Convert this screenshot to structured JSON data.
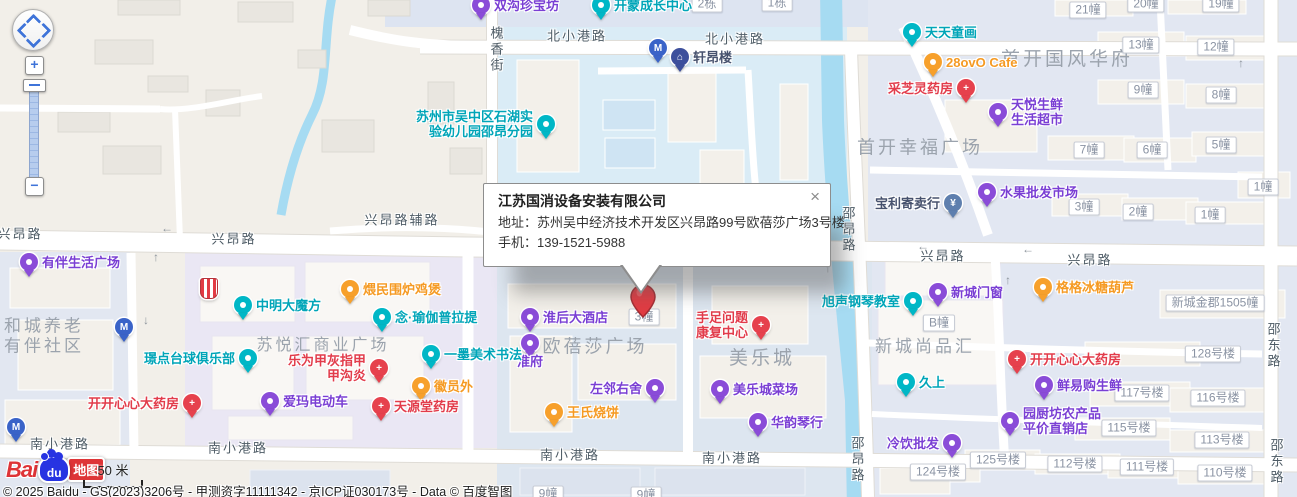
{
  "popup": {
    "title": "江苏国消设备安装有限公司",
    "address_label": "地址：",
    "address_value": "苏州吴中经济技术开发区兴昂路99号欧蓓莎广场3号楼",
    "phone_label": "手机：",
    "phone_value": "139-1521-5988",
    "close": "×"
  },
  "controls": {
    "zoom_in": "+",
    "zoom_out": "−"
  },
  "logo": {
    "bai": "Bai",
    "du": "du",
    "ditu": "地图"
  },
  "scale": {
    "label": "50 米"
  },
  "copyright": "© 2025 Baidu - GS(2023)3206号 - 甲测资字11111342 - 京ICP证030173号 - Data © 百度智图",
  "colors": {
    "teal": "#00b7c6",
    "purple": "#8a4cd8",
    "orange": "#f7a02b",
    "red": "#e6414d",
    "navy": "#3d4f9c",
    "blue": "#3a63c8",
    "steel": "#5e7fae",
    "label_teal": "#00a5b8",
    "label_purple": "#7a3fd4",
    "label_orange": "#f59a23",
    "label_red": "#e23c4b",
    "label_navy": "#47526e",
    "label_steel": "#47526e"
  },
  "map": {
    "road_labels": [
      {
        "x": 577,
        "y": 35,
        "text": "北小港路"
      },
      {
        "x": 735,
        "y": 38,
        "text": "北小港路"
      },
      {
        "x": 496,
        "y": 50,
        "text": "槐香街",
        "vertical": true
      },
      {
        "x": 402,
        "y": 219,
        "text": "兴昂路辅路"
      },
      {
        "x": 20,
        "y": 233,
        "text": "兴昂路"
      },
      {
        "x": 234,
        "y": 238,
        "text": "兴昂路"
      },
      {
        "x": 943,
        "y": 255,
        "text": "兴昂路"
      },
      {
        "x": 1090,
        "y": 259,
        "text": "兴昂路"
      },
      {
        "x": 60,
        "y": 443,
        "text": "南小港路"
      },
      {
        "x": 238,
        "y": 447,
        "text": "南小港路"
      },
      {
        "x": 570,
        "y": 454,
        "text": "南小港路"
      },
      {
        "x": 732,
        "y": 457,
        "text": "南小港路"
      },
      {
        "x": 848,
        "y": 230,
        "text": "邵昂路",
        "vertical": true
      },
      {
        "x": 857,
        "y": 460,
        "text": "邵昂路",
        "vertical": true
      },
      {
        "x": 1273,
        "y": 346,
        "text": "邵东路",
        "vertical": true
      },
      {
        "x": 1276,
        "y": 462,
        "text": "邵东路",
        "vertical": true
      }
    ],
    "area_labels": [
      {
        "x": 1067,
        "y": 60,
        "size": 19,
        "lines": [
          "首开国风华府"
        ]
      },
      {
        "x": 920,
        "y": 148,
        "size": 18,
        "lines": [
          "首开幸福广场"
        ]
      },
      {
        "x": 925,
        "y": 347,
        "size": 17,
        "lines": [
          "新城尚品汇"
        ]
      },
      {
        "x": 762,
        "y": 359,
        "size": 19,
        "lines": [
          "美乐城"
        ]
      },
      {
        "x": 595,
        "y": 347,
        "size": 18,
        "lines": [
          "欧蓓莎广场"
        ]
      },
      {
        "x": 323,
        "y": 346,
        "size": 16,
        "lines": [
          "苏悦汇商业广场"
        ]
      },
      {
        "x": 44,
        "y": 336,
        "size": 17,
        "lines": [
          "和城养老",
          "有伴社区"
        ]
      }
    ],
    "building_labels": [
      {
        "x": 707,
        "y": 4,
        "text": "2栋"
      },
      {
        "x": 777,
        "y": 3,
        "text": "1栋"
      },
      {
        "x": 1088,
        "y": 10,
        "text": "21幢"
      },
      {
        "x": 1146,
        "y": 4,
        "text": "20幢"
      },
      {
        "x": 1221,
        "y": 4,
        "text": "19幢"
      },
      {
        "x": 1141,
        "y": 45,
        "text": "13幢"
      },
      {
        "x": 1216,
        "y": 47,
        "text": "12幢"
      },
      {
        "x": 1143,
        "y": 90,
        "text": "9幢"
      },
      {
        "x": 1221,
        "y": 95,
        "text": "8幢"
      },
      {
        "x": 1089,
        "y": 150,
        "text": "7幢"
      },
      {
        "x": 1152,
        "y": 150,
        "text": "6幢"
      },
      {
        "x": 1221,
        "y": 145,
        "text": "5幢"
      },
      {
        "x": 1263,
        "y": 187,
        "text": "1幢"
      },
      {
        "x": 1084,
        "y": 207,
        "text": "3幢"
      },
      {
        "x": 1138,
        "y": 212,
        "text": "2幢"
      },
      {
        "x": 1210,
        "y": 215,
        "text": "1幢"
      },
      {
        "x": 939,
        "y": 323,
        "text": "B幢"
      },
      {
        "x": 1215,
        "y": 303,
        "text": "新城金郡1505幢"
      },
      {
        "x": 644,
        "y": 317,
        "text": "3幢"
      },
      {
        "x": 1213,
        "y": 354,
        "text": "128号楼"
      },
      {
        "x": 1142,
        "y": 393,
        "text": "117号楼"
      },
      {
        "x": 1218,
        "y": 398,
        "text": "116号楼"
      },
      {
        "x": 1129,
        "y": 428,
        "text": "115号楼"
      },
      {
        "x": 1222,
        "y": 440,
        "text": "113号楼"
      },
      {
        "x": 998,
        "y": 460,
        "text": "125号楼"
      },
      {
        "x": 938,
        "y": 472,
        "text": "124号楼"
      },
      {
        "x": 1075,
        "y": 464,
        "text": "112号楼"
      },
      {
        "x": 1147,
        "y": 467,
        "text": "111号楼"
      },
      {
        "x": 1225,
        "y": 473,
        "text": "110号楼"
      },
      {
        "x": 548,
        "y": 494,
        "text": "9幢"
      },
      {
        "x": 646,
        "y": 495,
        "text": "9幢"
      }
    ],
    "arrows": [
      {
        "x": 167,
        "y": 228,
        "ch": "←"
      },
      {
        "x": 923,
        "y": 246,
        "ch": "←"
      },
      {
        "x": 1028,
        "y": 249,
        "ch": "←"
      },
      {
        "x": 156,
        "y": 257,
        "ch": "↑"
      },
      {
        "x": 146,
        "y": 320,
        "ch": "↓"
      },
      {
        "x": 828,
        "y": 268,
        "ch": "↑"
      },
      {
        "x": 1241,
        "y": 63,
        "ch": "↑"
      },
      {
        "x": 1008,
        "y": 280,
        "ch": "↑"
      }
    ],
    "pois": [
      {
        "x": 481,
        "y": 5,
        "color": "purple",
        "glyph": "",
        "lines": [
          "双沟珍宝坊"
        ],
        "side": "right",
        "label_color": "label_purple"
      },
      {
        "x": 601,
        "y": 5,
        "color": "teal",
        "glyph": "",
        "lines": [
          "开蒙成长中心"
        ],
        "side": "right",
        "label_color": "label_teal"
      },
      {
        "x": 912,
        "y": 32,
        "color": "teal",
        "glyph": "",
        "lines": [
          "天天童画"
        ],
        "side": "right",
        "label_color": "label_teal"
      },
      {
        "x": 933,
        "y": 62,
        "color": "orange",
        "glyph": "",
        "lines": [
          "28ovO Cafe"
        ],
        "side": "right",
        "label_color": "label_orange"
      },
      {
        "x": 966,
        "y": 88,
        "color": "red",
        "glyph": "+",
        "lines": [
          "采芝灵药房"
        ],
        "side": "left",
        "label_color": "label_red"
      },
      {
        "x": 998,
        "y": 112,
        "color": "purple",
        "glyph": "",
        "lines": [
          "天悦生鲜",
          "生活超市"
        ],
        "side": "right",
        "label_color": "label_purple"
      },
      {
        "x": 546,
        "y": 124,
        "color": "teal",
        "glyph": "",
        "lines": [
          "苏州市吴中区石湖实",
          "验幼儿园邵昂分园"
        ],
        "side": "left",
        "label_color": "label_teal"
      },
      {
        "x": 680,
        "y": 57,
        "color": "navy",
        "glyph": "⌂",
        "lines": [
          "轩昂楼"
        ],
        "side": "right",
        "label_color": "label_navy"
      },
      {
        "x": 658,
        "y": 48,
        "color": "blue",
        "glyph": "M",
        "lines": [],
        "side": "right",
        "label_color": "label_navy"
      },
      {
        "x": 953,
        "y": 203,
        "color": "steel",
        "glyph": "¥",
        "lines": [
          "宝利寄卖行"
        ],
        "side": "left",
        "label_color": "label_steel"
      },
      {
        "x": 987,
        "y": 192,
        "color": "purple",
        "glyph": "",
        "lines": [
          "水果批发市场"
        ],
        "side": "right",
        "label_color": "label_purple"
      },
      {
        "x": 913,
        "y": 301,
        "color": "teal",
        "glyph": "",
        "lines": [
          "旭声钢琴教室"
        ],
        "side": "left",
        "label_color": "label_teal"
      },
      {
        "x": 938,
        "y": 292,
        "color": "purple",
        "glyph": "",
        "lines": [
          "新城门窗"
        ],
        "side": "right",
        "label_color": "label_purple"
      },
      {
        "x": 1043,
        "y": 287,
        "color": "orange",
        "glyph": "",
        "lines": [
          "格格冰糖葫芦"
        ],
        "side": "right",
        "label_color": "label_orange"
      },
      {
        "x": 906,
        "y": 382,
        "color": "teal",
        "glyph": "",
        "lines": [
          "久上"
        ],
        "side": "right",
        "label_color": "label_teal"
      },
      {
        "x": 1017,
        "y": 359,
        "color": "red",
        "glyph": "+",
        "lines": [
          "开开心心大药房"
        ],
        "side": "right",
        "label_color": "label_red"
      },
      {
        "x": 1044,
        "y": 385,
        "color": "purple",
        "glyph": "",
        "lines": [
          "鲜易购生鲜"
        ],
        "side": "right",
        "label_color": "label_purple"
      },
      {
        "x": 1010,
        "y": 421,
        "color": "purple",
        "glyph": "",
        "lines": [
          "园厨坊农产品",
          "平价直销店"
        ],
        "side": "right",
        "label_color": "label_purple"
      },
      {
        "x": 952,
        "y": 443,
        "color": "purple",
        "glyph": "",
        "lines": [
          "冷饮批发"
        ],
        "side": "left",
        "label_color": "label_purple"
      },
      {
        "x": 720,
        "y": 389,
        "color": "purple",
        "glyph": "",
        "lines": [
          "美乐城菜场"
        ],
        "side": "right",
        "label_color": "label_purple"
      },
      {
        "x": 758,
        "y": 422,
        "color": "purple",
        "glyph": "",
        "lines": [
          "华韵琴行"
        ],
        "side": "right",
        "label_color": "label_purple"
      },
      {
        "x": 761,
        "y": 325,
        "color": "red",
        "glyph": "+",
        "lines": [
          "手足问题",
          "康复中心"
        ],
        "side": "left",
        "label_color": "label_red"
      },
      {
        "x": 530,
        "y": 317,
        "color": "purple",
        "glyph": "",
        "lines": [
          "淮后大酒店"
        ],
        "side": "right",
        "label_color": "label_purple"
      },
      {
        "x": 530,
        "y": 343,
        "color": "purple",
        "glyph": "",
        "lines": [
          "淮府"
        ],
        "side": "below",
        "label_color": "label_purple"
      },
      {
        "x": 655,
        "y": 388,
        "color": "purple",
        "glyph": "",
        "lines": [
          "左邻右舍"
        ],
        "side": "left",
        "label_color": "label_purple"
      },
      {
        "x": 554,
        "y": 412,
        "color": "orange",
        "glyph": "",
        "lines": [
          "王氏烧饼"
        ],
        "side": "right",
        "label_color": "label_orange"
      },
      {
        "x": 431,
        "y": 354,
        "color": "teal",
        "glyph": "",
        "lines": [
          "一墨美术书法"
        ],
        "side": "right",
        "label_color": "label_teal"
      },
      {
        "x": 382,
        "y": 317,
        "color": "teal",
        "glyph": "",
        "lines": [
          "念·瑜伽普拉提"
        ],
        "side": "right",
        "label_color": "label_teal"
      },
      {
        "x": 350,
        "y": 289,
        "color": "orange",
        "glyph": "",
        "lines": [
          "煨民围炉鸡煲"
        ],
        "side": "right",
        "label_color": "label_orange"
      },
      {
        "x": 243,
        "y": 305,
        "color": "teal",
        "glyph": "",
        "lines": [
          "中明大魔方"
        ],
        "side": "right",
        "label_color": "label_teal"
      },
      {
        "x": 379,
        "y": 368,
        "color": "red",
        "glyph": "+",
        "lines": [
          "乐为甲灰指甲",
          "甲沟炎"
        ],
        "side": "left",
        "label_color": "label_red"
      },
      {
        "x": 248,
        "y": 358,
        "color": "teal",
        "glyph": "",
        "lines": [
          "璟点台球俱乐部"
        ],
        "side": "left",
        "label_color": "label_teal"
      },
      {
        "x": 421,
        "y": 386,
        "color": "orange",
        "glyph": "",
        "lines": [
          "徽员外"
        ],
        "side": "right",
        "label_color": "label_orange"
      },
      {
        "x": 270,
        "y": 401,
        "color": "purple",
        "glyph": "",
        "lines": [
          "爱玛电动车"
        ],
        "side": "right",
        "label_color": "label_purple"
      },
      {
        "x": 381,
        "y": 406,
        "color": "red",
        "glyph": "+",
        "lines": [
          "天源堂药房"
        ],
        "side": "right",
        "label_color": "label_red"
      },
      {
        "x": 192,
        "y": 403,
        "color": "red",
        "glyph": "+",
        "lines": [
          "开开心心大药房"
        ],
        "side": "left",
        "label_color": "label_red"
      },
      {
        "x": 29,
        "y": 262,
        "color": "purple",
        "glyph": "",
        "lines": [
          "有伴生活广场"
        ],
        "side": "right",
        "label_color": "label_purple"
      },
      {
        "x": 124,
        "y": 327,
        "color": "blue",
        "glyph": "M",
        "lines": [],
        "side": "right",
        "label_color": "label_navy"
      },
      {
        "x": 16,
        "y": 427,
        "color": "blue",
        "glyph": "M",
        "lines": [],
        "side": "right",
        "label_color": "label_navy"
      },
      {
        "x": 208,
        "y": 289,
        "color": "red",
        "glyph": "",
        "lines": [],
        "side": "right",
        "label_color": "label_red",
        "shape": "shield"
      }
    ]
  }
}
